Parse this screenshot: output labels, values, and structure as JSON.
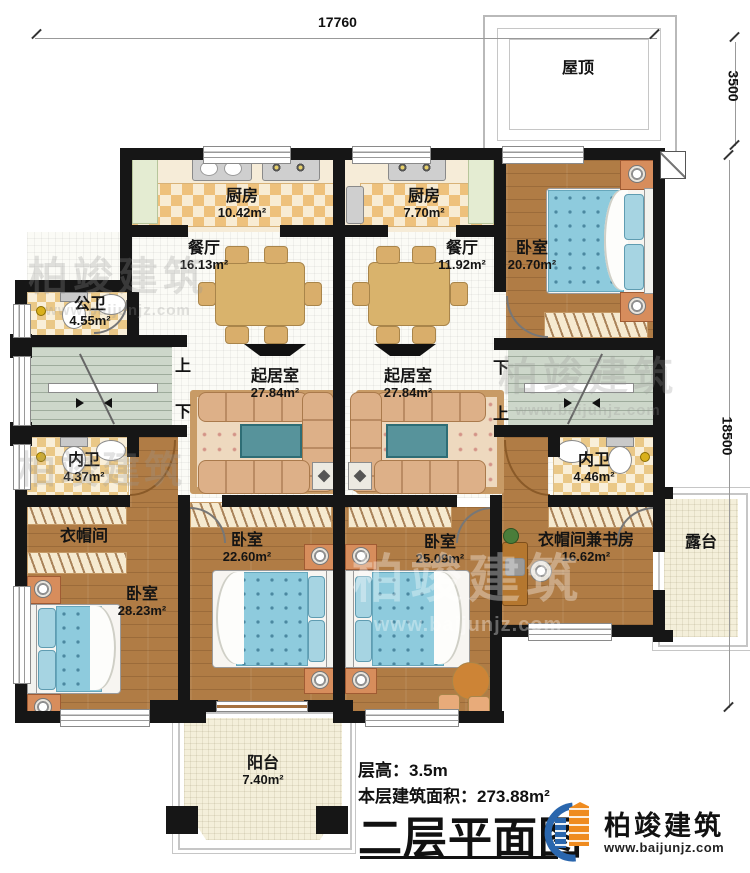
{
  "dims": {
    "width_top": "17760",
    "roof_side": "3500",
    "depth_side": "18500"
  },
  "roof": {
    "label": "屋顶"
  },
  "stairs": {
    "up": "上",
    "down": "下"
  },
  "rooms": {
    "kitchen_left": {
      "label": "厨房",
      "area": "10.42m²"
    },
    "kitchen_right": {
      "label": "厨房",
      "area": "7.70m²"
    },
    "dining_left": {
      "label": "餐厅",
      "area": "16.13m²"
    },
    "dining_right": {
      "label": "餐厅",
      "area": "11.92m²"
    },
    "bedroom_top_right": {
      "label": "卧室",
      "area": "20.70m²"
    },
    "public_bath": {
      "label": "公卫",
      "area": "4.55m²"
    },
    "living_left": {
      "label": "起居室",
      "area": "27.84m²"
    },
    "living_right": {
      "label": "起居室",
      "area": "27.84m²"
    },
    "bath_left": {
      "label": "内卫",
      "area": "4.37m²"
    },
    "bath_right": {
      "label": "内卫",
      "area": "4.46m²"
    },
    "cloakroom": {
      "label": "衣帽间"
    },
    "bedroom_bottom_left": {
      "label": "卧室",
      "area": "28.23m²"
    },
    "bedroom_mid_left": {
      "label": "卧室",
      "area": "22.60m²"
    },
    "bedroom_mid_right": {
      "label": "卧室",
      "area": "25.09m²"
    },
    "cloak_study": {
      "label": "衣帽间兼书房",
      "area": "16.62m²"
    },
    "terrace": {
      "label": "露台"
    },
    "balcony": {
      "label": "阳台",
      "area": "7.40m²"
    }
  },
  "info": {
    "floor_height": "层高：3.5m",
    "floor_area": "本层建筑面积：273.88m²"
  },
  "plan_title": "二层平面图",
  "brand": {
    "name": "柏竣建筑",
    "url": "www.baijunjz.com"
  },
  "colors": {
    "wall": "#161616",
    "wood": "#b07c45",
    "mattress": "#8ecbdd",
    "sofa": "#ddb088",
    "brand_orange": "#ef8b1f",
    "brand_blue": "#2a66ad"
  }
}
